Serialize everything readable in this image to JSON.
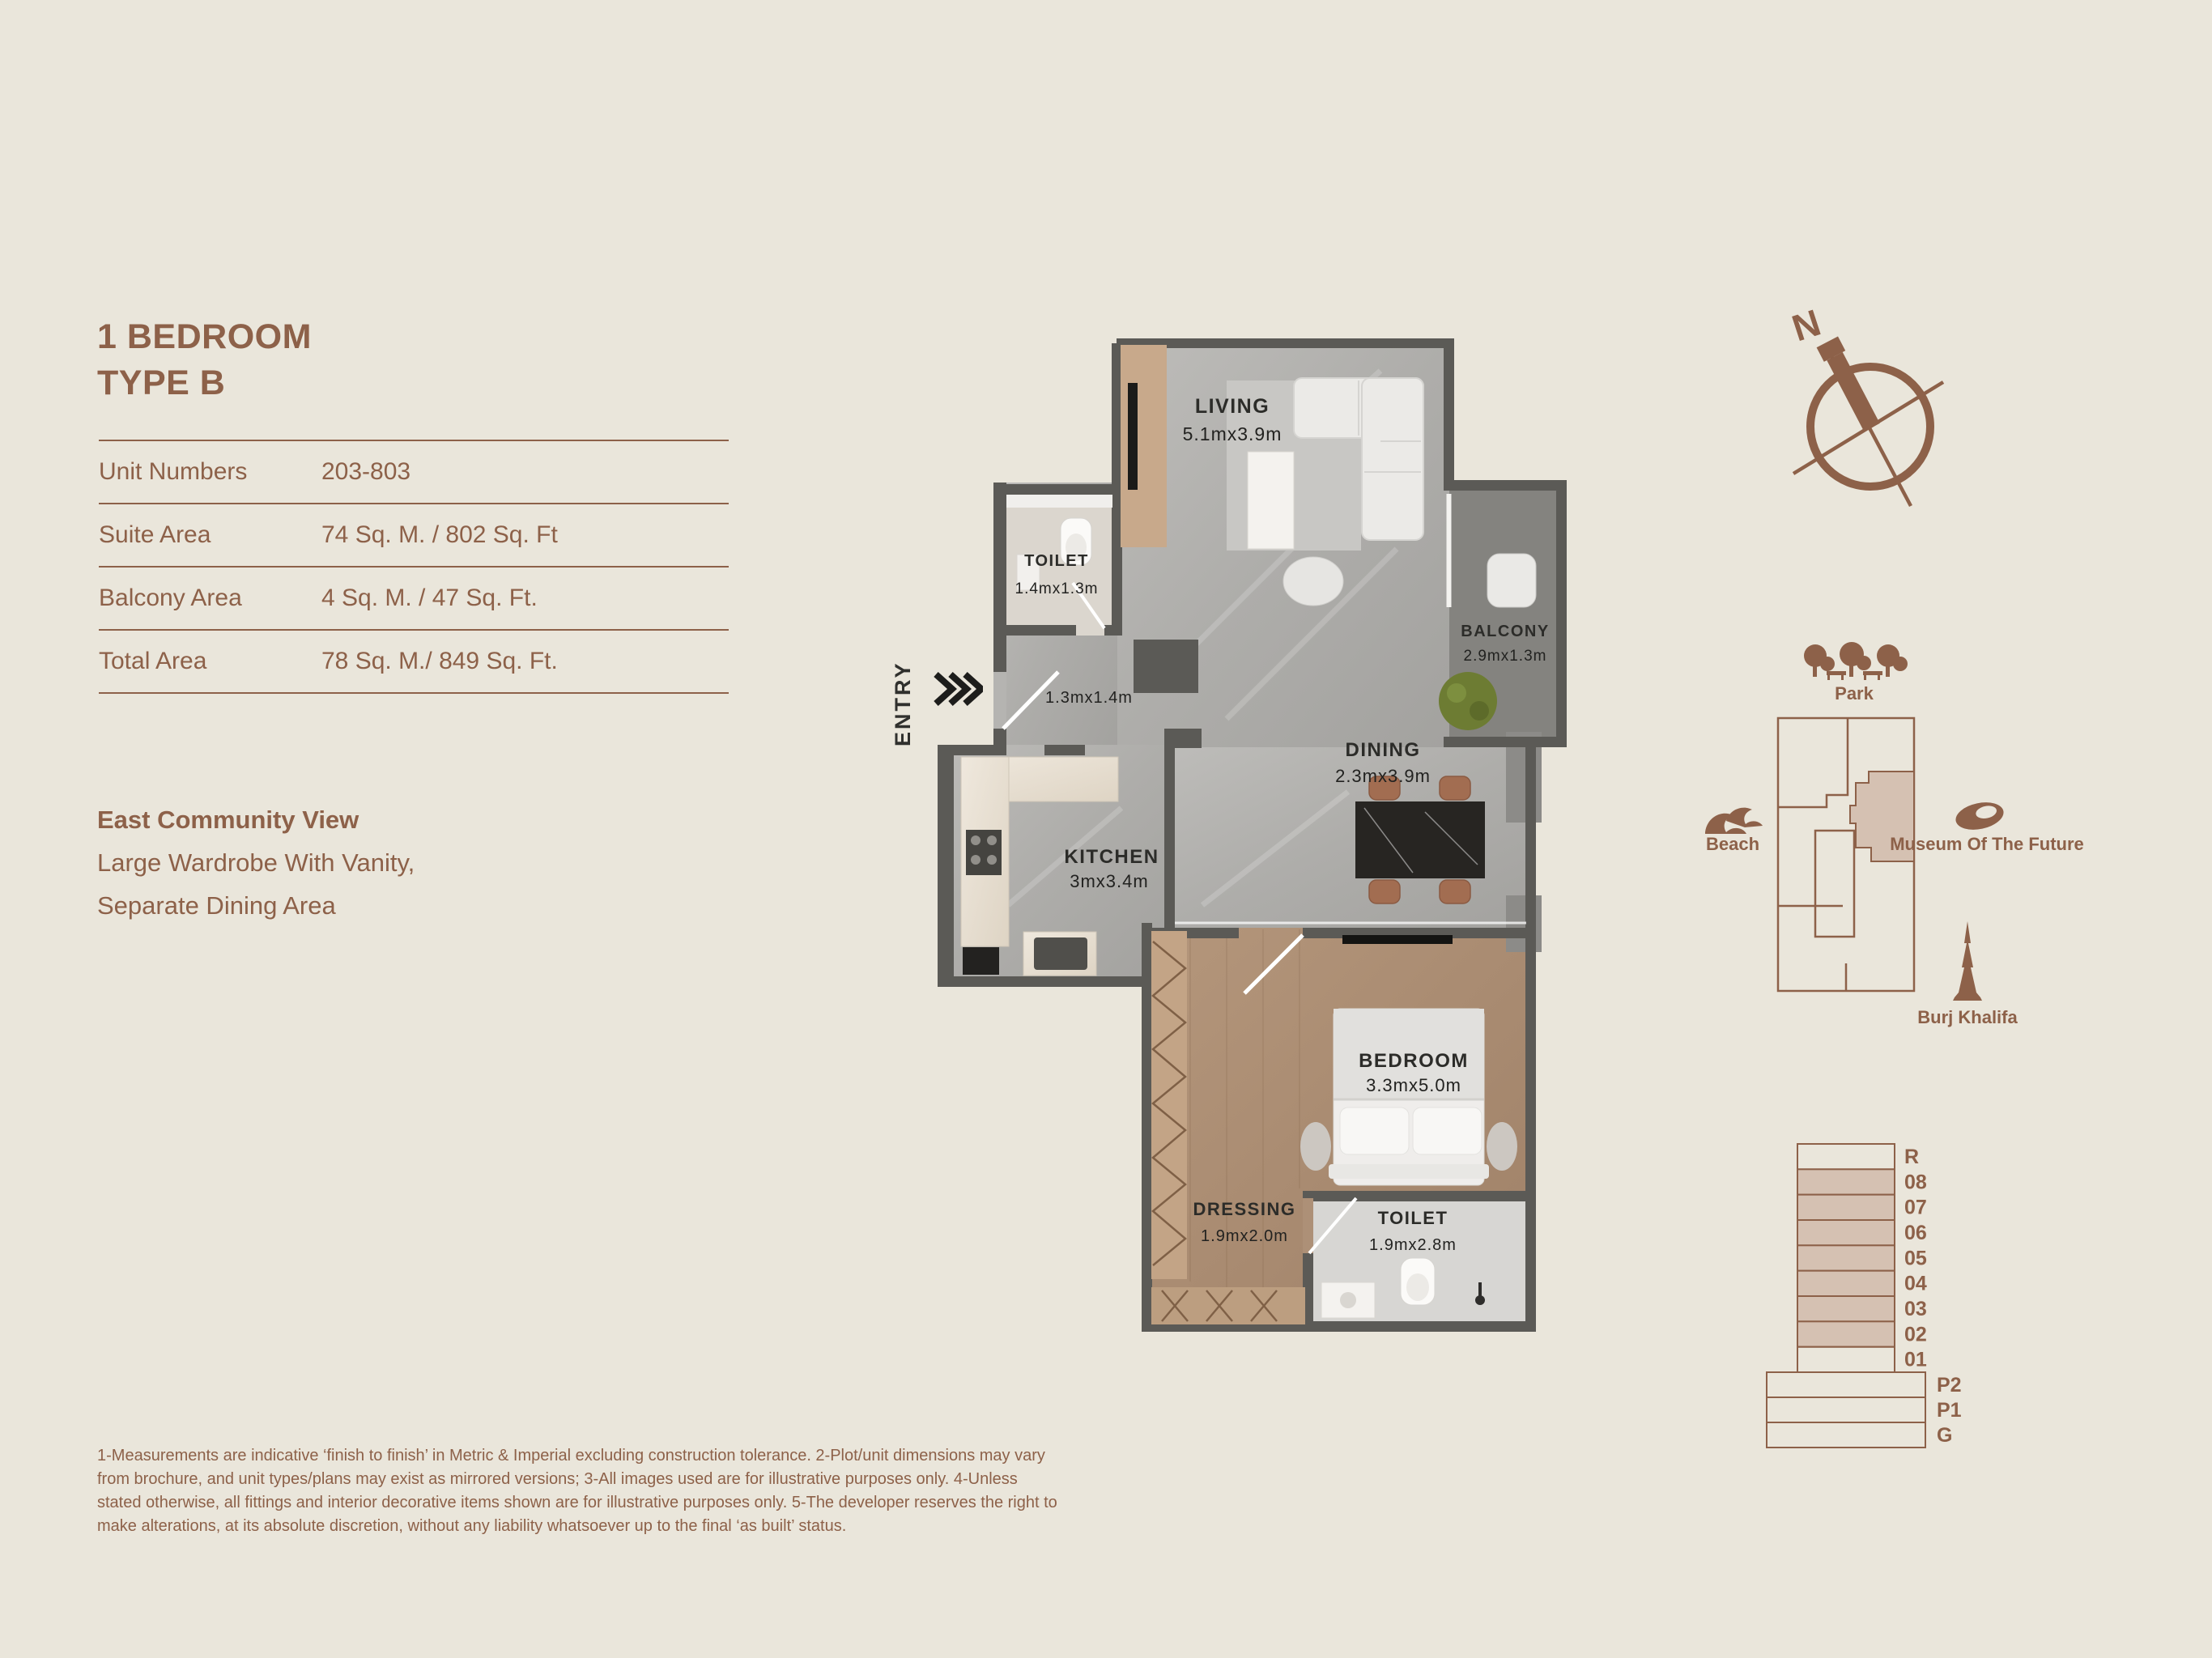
{
  "page": {
    "bg": "#EAE6DB",
    "accent": "#8D6149",
    "highlight": "#D5C1B2"
  },
  "info_panel": {
    "title_line1": "1 BEDROOM",
    "title_line2": "TYPE B",
    "table_rows": [
      {
        "label": "Unit Numbers",
        "value": "203-803"
      },
      {
        "label": "Suite Area",
        "value": "74 Sq. M. / 802 Sq. Ft"
      },
      {
        "label": "Balcony Area",
        "value": "4 Sq. M. / 47 Sq. Ft."
      },
      {
        "label": "Total Area",
        "value": "78 Sq. M./ 849 Sq. Ft."
      }
    ],
    "features": {
      "line1": "East Community View",
      "line2": "Large Wardrobe With Vanity,",
      "line3": "Separate Dining Area"
    }
  },
  "floor_plan": {
    "entry": {
      "label": "ENTRY",
      "arrows_icon": "triple-chevron-right"
    },
    "rooms": {
      "living": {
        "name": "LIVING",
        "dims": "5.1mx3.9m"
      },
      "toilet1": {
        "name": "TOILET",
        "dims": "1.4mx1.3m"
      },
      "hall": {
        "dims": "1.3mx1.4m"
      },
      "balcony": {
        "name": "BALCONY",
        "dims": "2.9mx1.3m"
      },
      "dining": {
        "name": "DINING",
        "dims": "2.3mx3.9m"
      },
      "kitchen": {
        "name": "KITCHEN",
        "dims": "3mx3.4m"
      },
      "bedroom": {
        "name": "BEDROOM",
        "dims": "3.3mx5.0m"
      },
      "dressing": {
        "name": "DRESSING",
        "dims": "1.9mx2.0m"
      },
      "toilet2": {
        "name": "TOILET",
        "dims": "1.9mx2.8m"
      }
    }
  },
  "compass": {
    "north_label": "N"
  },
  "landmarks": {
    "park": "Park",
    "beach": "Beach",
    "museum": "Museum Of The Future",
    "burj": "Burj Khalifa"
  },
  "floor_stack": {
    "floors": [
      {
        "label": "R",
        "highlighted": false
      },
      {
        "label": "08",
        "highlighted": true
      },
      {
        "label": "07",
        "highlighted": true
      },
      {
        "label": "06",
        "highlighted": true
      },
      {
        "label": "05",
        "highlighted": true
      },
      {
        "label": "04",
        "highlighted": true
      },
      {
        "label": "03",
        "highlighted": true
      },
      {
        "label": "02",
        "highlighted": true
      },
      {
        "label": "01",
        "highlighted": false
      }
    ],
    "podium": [
      {
        "label": "P2"
      },
      {
        "label": "P1"
      },
      {
        "label": "G"
      }
    ]
  },
  "disclaimer": "1-Measurements are indicative ‘finish to finish’ in Metric & Imperial excluding construction tolerance. 2-Plot/unit dimensions may vary from brochure, and unit types/plans may exist as mirrored versions; 3-All images used are for illustrative purposes only. 4-Unless stated otherwise, all fittings and interior decorative items shown are for illustrative purposes only. 5-The developer reserves the right to make alterations, at its absolute discretion, without any liability whatsoever up to the final ‘as built’ status."
}
